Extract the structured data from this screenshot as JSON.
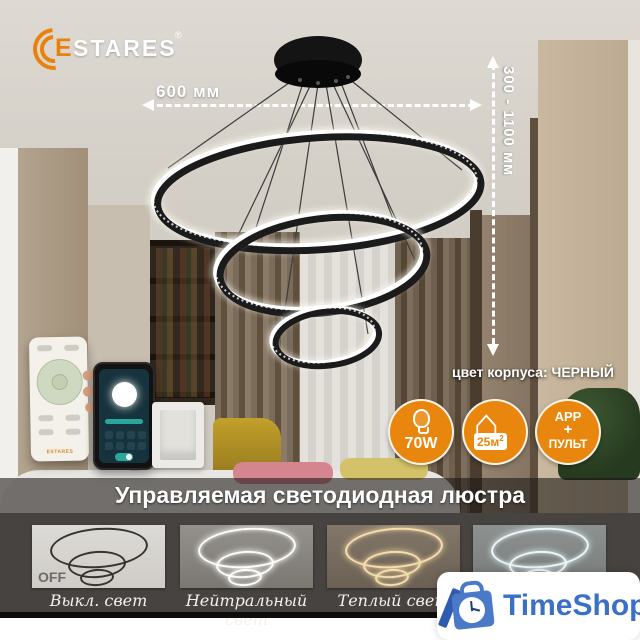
{
  "brand": {
    "e": "E",
    "name": "STARES",
    "registered": "®",
    "remote_logo": "ESTARES"
  },
  "dimensions": {
    "width_label": "600 мм",
    "height_label": "300 - 1100 мм"
  },
  "product": {
    "body_color_label": "цвет корпуса: ЧЕРНЫЙ",
    "banner_title": "Управляемая светодиодная люстра"
  },
  "badges": {
    "power": {
      "icon": "bulb-icon",
      "label": "70W"
    },
    "area": {
      "icon": "house-icon",
      "value": "25м",
      "sup": "2"
    },
    "control": {
      "line1": "APP",
      "line2": "+",
      "line3": "ПУЛЬТ"
    }
  },
  "modes": {
    "off_tag": "OFF",
    "items": [
      {
        "state": "off",
        "caption": "Выкл. свет"
      },
      {
        "state": "neutral",
        "caption": "Нейтральный свет"
      },
      {
        "state": "warm",
        "caption": "Теплый свет"
      },
      {
        "state": "cool",
        "caption": ""
      }
    ]
  },
  "retailer": {
    "name": "TimeShop"
  },
  "colors": {
    "accent_orange": "#e8860d",
    "brand_blue": "#3a70c6",
    "glow_neutral": "#ffffff",
    "glow_warm": "#f4dfb2"
  }
}
